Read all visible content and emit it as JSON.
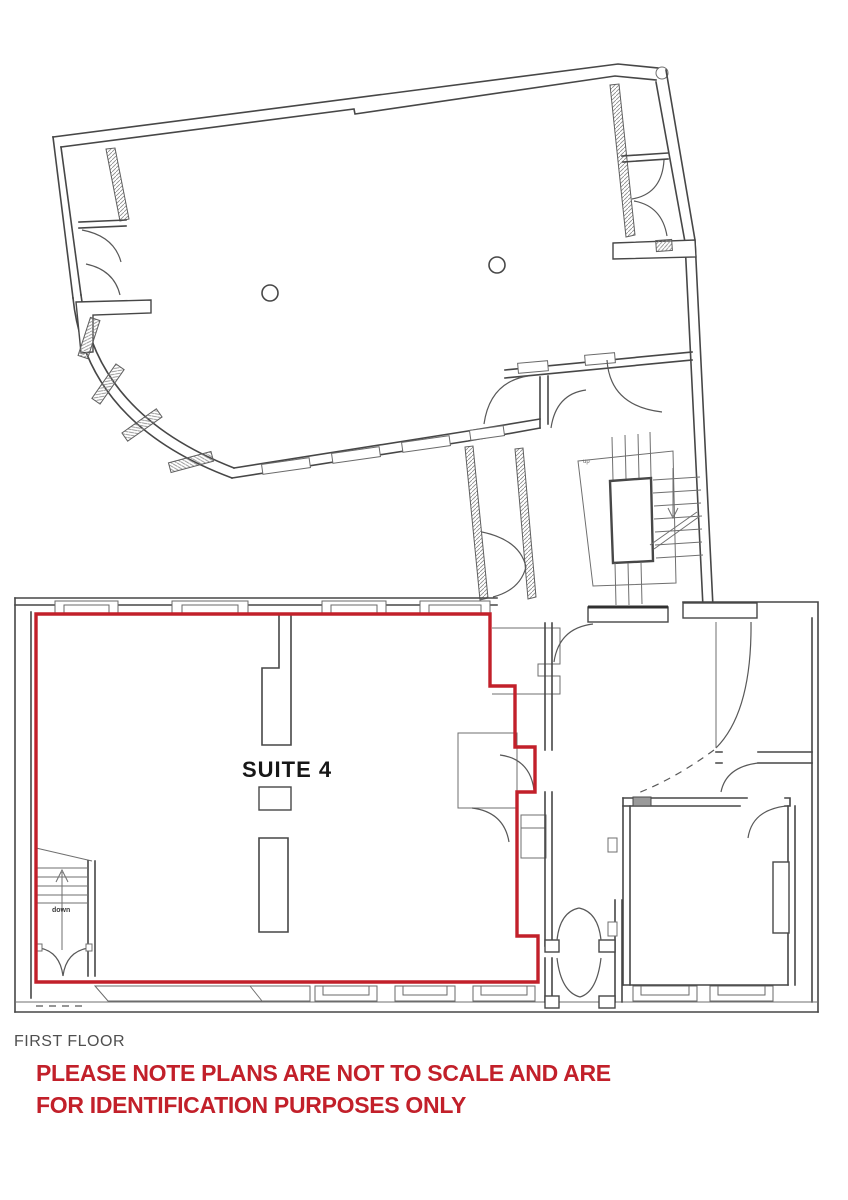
{
  "labels": {
    "suite": "SUITE 4",
    "stair_direction_down": "down",
    "stair_direction_up": "up",
    "floor_title": "FIRST FLOOR",
    "disclaimer_line1": "PLEASE NOTE PLANS ARE NOT TO SCALE AND ARE",
    "disclaimer_line2": "FOR IDENTIFICATION PURPOSES ONLY"
  },
  "colors": {
    "background": "#ffffff",
    "wall_line": "#474747",
    "thin_line": "#6f6f6f",
    "suite_outline_red": "#c2202a",
    "disclaimer_red": "#c2202a",
    "title_gray": "#4f4f4f"
  }
}
